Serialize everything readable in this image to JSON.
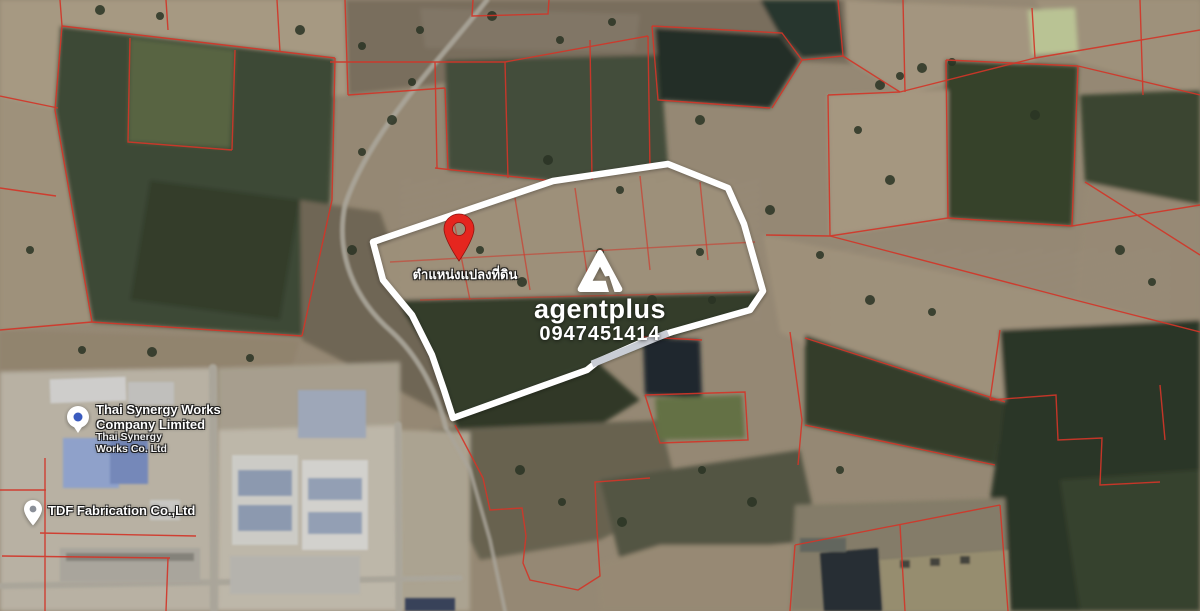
{
  "map": {
    "view": "satellite",
    "property": {
      "pin_label": "ตำแหน่งแปลงที่ดิน",
      "pin_color": "#e5261f",
      "boundary_color": "#ffffff",
      "boundary_gray_segment_color": "#c9cdd5"
    },
    "watermark": {
      "brand": "agentplus",
      "phone": "0947451414",
      "logo": "agentplus-triangle-mark",
      "color": "#ffffff"
    },
    "pois": [
      {
        "type": "business-dot-marker",
        "name_line1": "Thai Synergy Works",
        "name_line2": "Company Limited",
        "subname_line1": "Thai Synergy",
        "subname_line2": "Works Co. Ltd"
      },
      {
        "type": "teardrop-pin-marker",
        "name_line1": "TDF Fabrication Co.,Ltd"
      }
    ],
    "overlay_colors": {
      "cadastral_line": "#e33b2c",
      "road": "#b7b2a6",
      "water_dark": "#26322b",
      "water_light": "#c8d2a0"
    }
  }
}
